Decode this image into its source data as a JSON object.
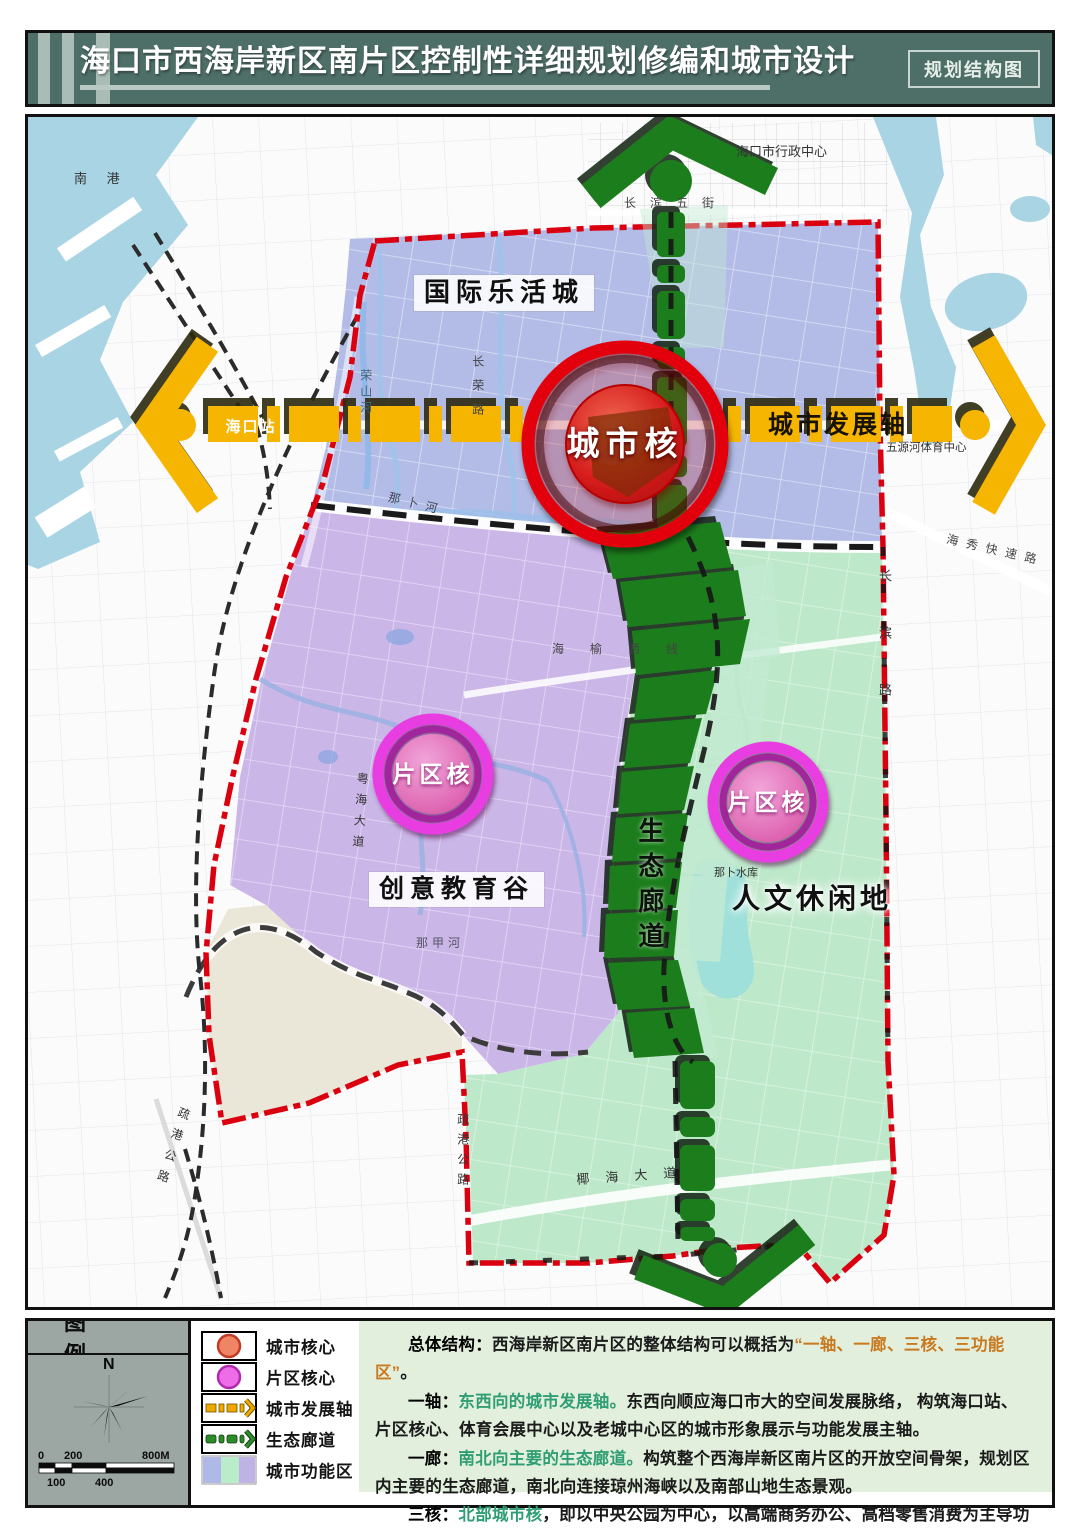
{
  "header": {
    "title": "海口市西海岸新区南片区控制性详细规划修编和城市设计",
    "badge": "规划结构图"
  },
  "map": {
    "labels": {
      "lohas_city": "国际乐活城",
      "city_core": "城市核",
      "dev_axis": "城市发展轴",
      "district_core": "片区核",
      "creative_valley": "创意教育谷",
      "eco_corridor": "生态廊道",
      "leisure_land": "人文休闲地",
      "south_port": "南 港",
      "admin_center": "海口市行政中心",
      "changbin_5th_street": "长滨五街",
      "haikou_station": "海口站",
      "wuyuanhe_sports_center": "五源河体育中心",
      "haixiu_expressway": "海秀快速路",
      "nabu_river": "那卜河",
      "haiyu_west_line": "海榆西线",
      "najia_river": "那甲河",
      "yuehai_avenue": "粤海大道",
      "rongshan_river": "荣山河",
      "changrong_road": "长荣路",
      "shugang_highway": "疏港公路",
      "changbin_road": "长滨路",
      "nabu_reservoir": "那卜水库",
      "yehai_avenue": "椰海大道"
    },
    "colors": {
      "lohas_zone": "#aab5e4",
      "creative_zone": "#c5aee6",
      "leisure_zone": "#b9e6c5",
      "corridor": "#1e7d1e",
      "axis": "#f5b500",
      "core": "#e2000f",
      "district_core": "#e83ce0",
      "boundary": "#da0010",
      "water": "#a9d4e3"
    }
  },
  "legend": {
    "title": "图例",
    "north": "N",
    "scale": {
      "start": "0",
      "mid": "200",
      "end": "800M",
      "b1": "100",
      "b2": "400"
    },
    "items": [
      {
        "label": "城市核心",
        "color": "#f08565"
      },
      {
        "label": "片区核心",
        "color": "#ee6ce8"
      },
      {
        "label": "城市发展轴",
        "color": "#f0a800"
      },
      {
        "label": "生态廊道",
        "color": "#2e8b2a"
      },
      {
        "label": "城市功能区",
        "colors": [
          "#aeb9e8",
          "#b9ecc9",
          "#bfb2e4"
        ]
      }
    ]
  },
  "description": {
    "paragraphs": [
      {
        "segments": [
          {
            "t": "总体结构：",
            "c": "lead"
          },
          {
            "t": "西海岸新区南片区的整体结构可以概括为"
          },
          {
            "t": "“一轴、一廊、三核、三功能区”",
            "c": "orange"
          },
          {
            "t": "。"
          }
        ]
      },
      {
        "segments": [
          {
            "t": "一轴：",
            "c": "lead"
          },
          {
            "t": "东西向的城市发展轴。",
            "c": "green"
          },
          {
            "t": "东西向顺应海口市大的空间发展脉络， 构筑海口站、片区核心、体育会展中心以及老城中心区的城市形象展示与功能发展主轴。"
          }
        ]
      },
      {
        "segments": [
          {
            "t": "一廊：",
            "c": "lead"
          },
          {
            "t": "南北向主要的生态廊道。",
            "c": "green"
          },
          {
            "t": "构筑整个西海岸新区南片区的开放空间骨架，规划区内主要的生态廊道，南北向连接琼州海峡以及南部山地生态景观。"
          }
        ]
      },
      {
        "segments": [
          {
            "t": "三核：",
            "c": "lead"
          },
          {
            "t": "北部城市核",
            "c": "green"
          },
          {
            "t": "，即以中央公园为中心，以高端商务办公、高档零售消费为主导功能的城市商务中心；"
          },
          {
            "t": "两个南部片区核",
            "c": "green"
          },
          {
            "t": "，分别为创意谷与人文休闲地的片区发展核心。"
          }
        ]
      }
    ]
  }
}
